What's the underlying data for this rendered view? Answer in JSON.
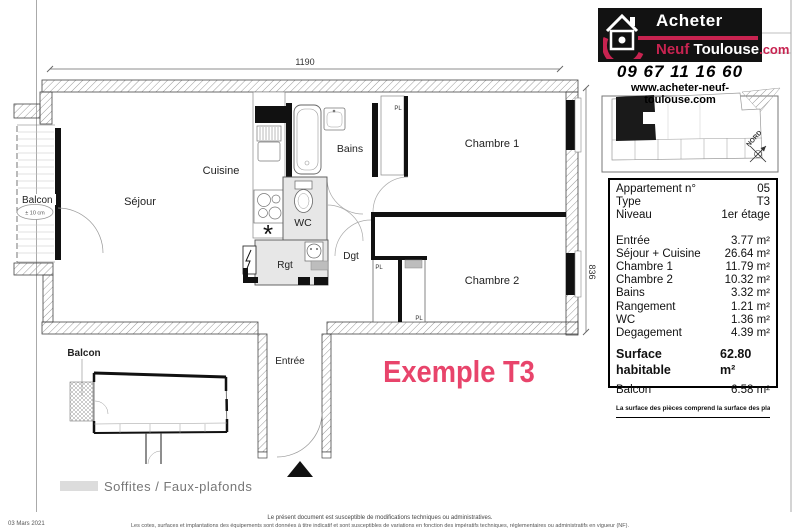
{
  "header": {
    "logo": {
      "acheter": "Acheter",
      "neuf": "Neuf",
      "toulouse": "Toulouse",
      "com": ".com"
    },
    "phone": "09 67 11 16 60",
    "website": "www.acheter-neuf-toulouse.com",
    "compass": "NORD"
  },
  "panel": {
    "info": [
      {
        "label": "Appartement n°",
        "value": "05"
      },
      {
        "label": "Type",
        "value": "T3"
      },
      {
        "label": "Niveau",
        "value": "1er étage"
      }
    ],
    "areas": [
      {
        "label": "Entrée",
        "value": "3.77 m²"
      },
      {
        "label": "Séjour + Cuisine",
        "value": "26.64 m²"
      },
      {
        "label": "Chambre 1",
        "value": "11.79 m²"
      },
      {
        "label": "Chambre 2",
        "value": "10.32 m²"
      },
      {
        "label": "Bains",
        "value": "3.32 m²"
      },
      {
        "label": "Rangement",
        "value": "1.21 m²"
      },
      {
        "label": "WC",
        "value": "1.36 m²"
      },
      {
        "label": "Degagement",
        "value": "4.39 m²"
      }
    ],
    "total": {
      "label": "Surface habitable",
      "value": "62.80 m²"
    },
    "balcony": {
      "label": "Balcon",
      "value": "6.58 m²"
    },
    "footnote": "La surface des pièces comprend la surface des placards"
  },
  "plan": {
    "dim_width": "1190",
    "dim_height": "836",
    "rooms": {
      "balcon": "Balcon",
      "sejour": "Séjour",
      "cuisine": "Cuisine",
      "bains": "Bains",
      "wc": "WC",
      "rgt": "Rgt",
      "dgt": "Dgt",
      "chambre1": "Chambre 1",
      "chambre2": "Chambre 2",
      "entree": "Entrée",
      "pl": "PL"
    },
    "balcony_note": "± 10 cm",
    "star": "*",
    "example_label": "Exemple T3",
    "mini_plan_label": "Balcon",
    "legend": "Soffites / Faux-plafonds"
  },
  "footer": {
    "line1": "Le présent document est susceptible de modifications techniques ou administratives.",
    "line2": "Les cotes, surfaces et implantations des équipements sont données à titre indicatif et sont susceptibles de variations en fonction des impératifs techniques, réglementaires ou administratifs en vigueur (NF).",
    "date": "03 Mars 2021"
  },
  "colors": {
    "logo_red": "#c72350",
    "example_pink": "#e8446b",
    "soffit_gray": "#e7e7e7",
    "wall_black": "#111111"
  }
}
